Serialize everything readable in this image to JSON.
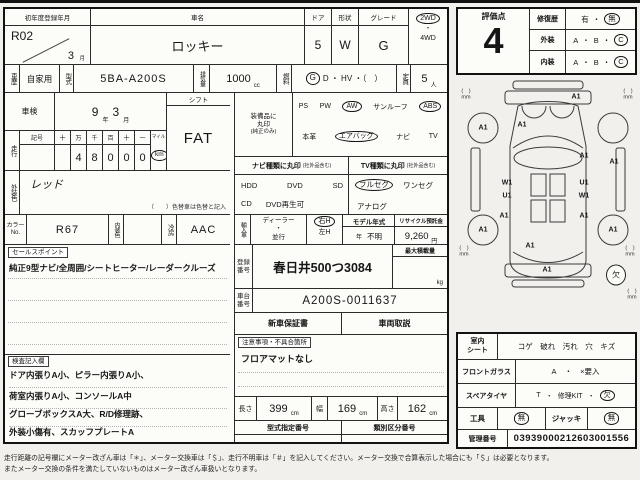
{
  "head": {
    "first_reg_label": "初年度登録年月",
    "reg_year": "R02",
    "reg_month": "3",
    "month_unit": "月",
    "car_name_label": "車名",
    "car_name": "ロッキー",
    "door_label": "ドア",
    "door": "5",
    "shape_label": "形状",
    "shape": "W",
    "grade_label": "グレード",
    "grade": "G",
    "d2wd": "2WD",
    "dot": "・",
    "d4wd": "4WD"
  },
  "spec": {
    "history_label": "車歴",
    "history": "自家用",
    "model_label": "型式",
    "model": "5BA-A200S",
    "disp_label": "排気量",
    "disp": "1000",
    "cc": "cc",
    "fuel_label": "燃料",
    "fuel_g": "G",
    "fuel_rest": "D ・ HV ・（　）",
    "cap_label": "定員",
    "cap": "5",
    "cap_unit": "人"
  },
  "shaken": {
    "label": "車検",
    "year": "9",
    "year_unit": "年",
    "month": "3",
    "month_unit": "月"
  },
  "shift": {
    "label": "シフト",
    "value": "FAT"
  },
  "mileage": {
    "label": "走行",
    "sym_label": "記号",
    "col_labels": [
      "十",
      "万",
      "千",
      "百",
      "十",
      "一"
    ],
    "digits": [
      "",
      "4",
      "8",
      "0",
      "0",
      "0"
    ],
    "mile": "マイル",
    "km": "km"
  },
  "equip": {
    "l1": "装備品に",
    "l2": "丸印",
    "l3": "(純正のみ)",
    "ps": "PS",
    "pw": "PW",
    "aw": "AW",
    "sunroof": "サンルーフ",
    "abs": "ABS",
    "leather": "本革",
    "airbag": "エアバッグ",
    "navi": "ナビ",
    "tv": "TV"
  },
  "navi": {
    "header": "ナビ種類に丸印",
    "note": "(社外品含む)",
    "hdd": "HDD",
    "dvd": "DVD",
    "sd": "SD",
    "cd": "CD",
    "dvdplay": "DVD再生可"
  },
  "tv": {
    "header": "TV種類に丸印",
    "note": "(社外品含む)",
    "full": "フルセグ",
    "one": "ワンセグ",
    "analog": "アナログ"
  },
  "extcolor": {
    "label": "外装色",
    "value": "レッド",
    "note": "（　　）色替車は色替と記入"
  },
  "colorrow": {
    "no_label": "カラーNo.",
    "no": "R67",
    "int_label": "内装色",
    "int_value": "",
    "ac_label": "冷房",
    "ac": "AAC"
  },
  "importrow": {
    "label": "輸入車",
    "dealer": "ディーラー",
    "dot": "・",
    "parallel": "並行",
    "rh": "右H",
    "lh": "左H",
    "my_label": "モデル年式",
    "y_unit": "年",
    "y_val": "不明",
    "rec_label": "リサイクル預託金",
    "rec": "9,260",
    "yen": "円"
  },
  "reg": {
    "label": "登録番号",
    "value": "春日井500つ3084",
    "load_label": "最大積載量",
    "kg": "kg",
    "chassis_label": "車台番号",
    "chassis": "A200S-0011637",
    "warranty": "新車保証書",
    "manual": "車両取説"
  },
  "sales": {
    "tag": "セールスポイント",
    "text": "純正9型ナビ/全周囲/シートヒーター/レーダークルーズ"
  },
  "notes": {
    "tag": "注意事項・不具合箇所",
    "text": "フロアマットなし"
  },
  "inspector": {
    "tag": "検査記入欄",
    "lines": [
      "ドア内張りA小、ピラー内張りA小、",
      "荷室内張りA小、コンソールA中",
      "グローブボックスA大、R/D修理跡、",
      "外装小傷有、スカッフプレートA"
    ]
  },
  "dims": {
    "l_label": "長さ",
    "l": "399",
    "w_label": "幅",
    "w": "169",
    "h_label": "高さ",
    "h": "162",
    "cm": "cm"
  },
  "typenums": {
    "model_label": "型式指定番号",
    "class_label": "類別区分番号"
  },
  "rating": {
    "label": "評価点",
    "score": "4",
    "repair_label": "修復歴",
    "yes": "有",
    "dot": "・",
    "no": "無",
    "ext_label": "外装",
    "int_label": "内装",
    "a": "A",
    "b": "B",
    "c": "C"
  },
  "diagram": {
    "marks": [
      {
        "t": "A1",
        "x": 120,
        "y": 19
      },
      {
        "t": "A1",
        "x": 66,
        "y": 47
      },
      {
        "t": "A1",
        "x": 27,
        "y": 50
      },
      {
        "t": "A1",
        "x": 128,
        "y": 78
      },
      {
        "t": "A1",
        "x": 158,
        "y": 84
      },
      {
        "t": "W1",
        "x": 51,
        "y": 105
      },
      {
        "t": "U1",
        "x": 51,
        "y": 118
      },
      {
        "t": "U1",
        "x": 128,
        "y": 105
      },
      {
        "t": "W1",
        "x": 128,
        "y": 118
      },
      {
        "t": "A1",
        "x": 48,
        "y": 138
      },
      {
        "t": "A1",
        "x": 128,
        "y": 138
      },
      {
        "t": "A1",
        "x": 27,
        "y": 152
      },
      {
        "t": "A1",
        "x": 157,
        "y": 152
      },
      {
        "t": "A1",
        "x": 74,
        "y": 168
      },
      {
        "t": "A1",
        "x": 91,
        "y": 192
      }
    ],
    "paren": "(　)",
    "mm": "mm",
    "mm_marks": [
      {
        "x": 10,
        "y": 17
      },
      {
        "x": 172,
        "y": 17
      },
      {
        "x": 8,
        "y": 174
      },
      {
        "x": 174,
        "y": 174
      },
      {
        "x": 176,
        "y": 217
      }
    ],
    "missing": "欠",
    "missing_x": 160,
    "missing_y": 197
  },
  "cond": {
    "seat_l1": "室内",
    "seat_l2": "シート",
    "seat_items": "コゲ　破れ　汚れ　穴　キズ",
    "glass_label": "フロントガラス",
    "glass_a": "A",
    "dot": "・",
    "glass_x": "×要入",
    "spare_label": "スペアタイヤ",
    "spare_t": "T",
    "spare_kit": "修理KIT",
    "spare_miss": "欠",
    "tools_label": "工具",
    "none1": "無",
    "jack_label": "ジャッキ",
    "none2": "無",
    "mgmt_label": "管理番号",
    "mgmt": "03939000212603001556"
  },
  "disclaimer": {
    "line1": "走行距離の記号欄にメーター改ざん車は「＊」、メーター交換車は「＄」、走行不明車は「＃」を記入してください。メーター交換で合算表示した場合にも「＄」は必要となります。",
    "line2": "またメーター交換の条件を満たしていないものはメーター改ざん車扱いとなります。"
  }
}
